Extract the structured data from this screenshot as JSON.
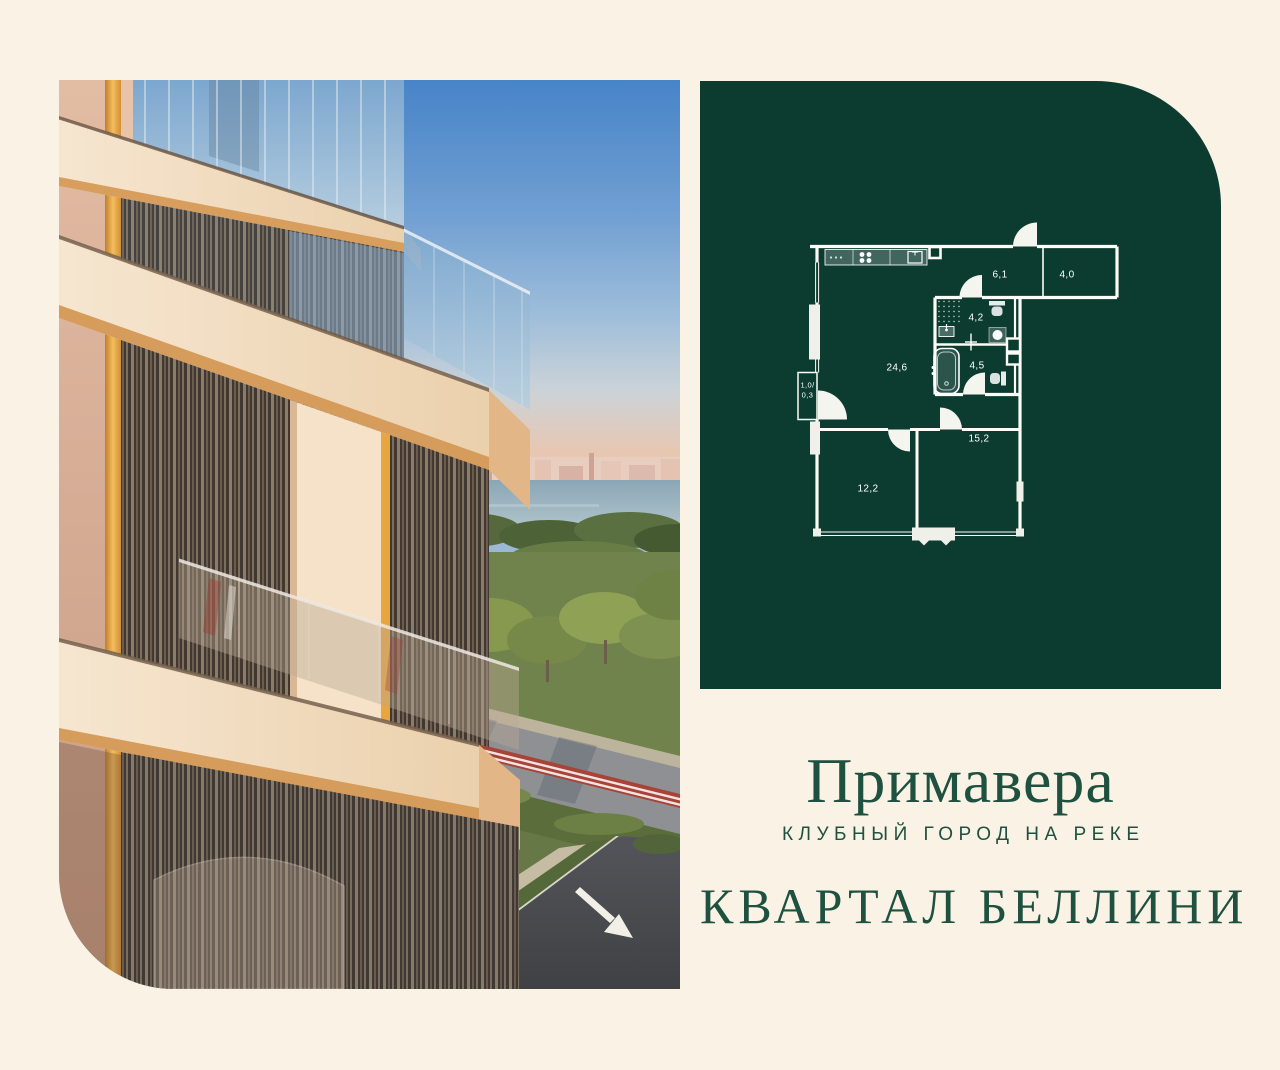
{
  "page": {
    "background_color": "#FAF2E4"
  },
  "floorplan_panel": {
    "background_color": "#0C3B30",
    "line_color": "#FFFFFF",
    "rooms": {
      "kitchen_living": "24,6",
      "hallway": "6,1",
      "storage": "4,0",
      "bathroom_upper": "4,2",
      "bathroom_lower": "4,5",
      "bedroom_right": "15,2",
      "bedroom_left": "12,2",
      "balcony_line1": "1,0/",
      "balcony_line2": "0,3"
    }
  },
  "branding": {
    "project_name": "Примавера",
    "tagline": "КЛУБНЫЙ ГОРОД НА РЕКЕ",
    "quarter_title": "КВАРТАЛ БЕЛЛИНИ",
    "text_color": "#1F5140"
  }
}
